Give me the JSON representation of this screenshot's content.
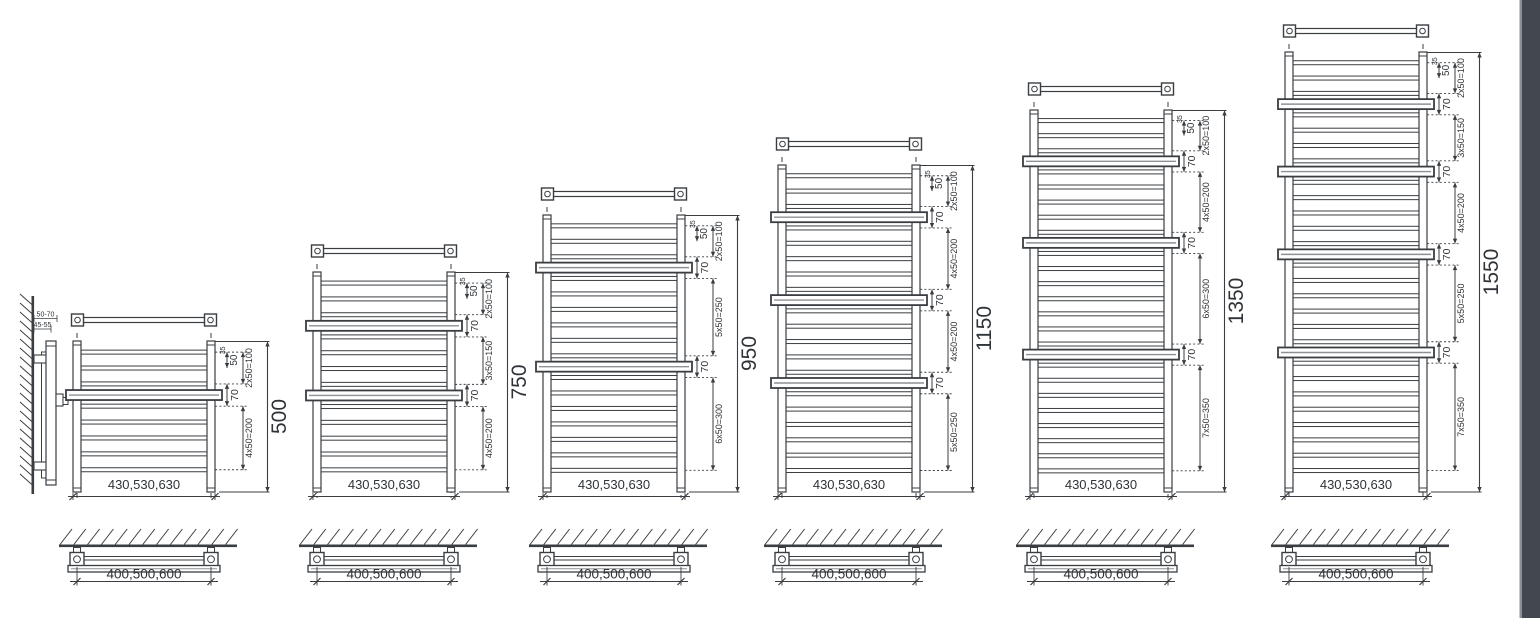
{
  "drawing": {
    "type": "towel-radiator-dimension-diagram",
    "colors": {
      "line": "#3a3e42",
      "text": "#2f3337",
      "mid_gray": "#8d9196",
      "page_edge_strip": "#43484e",
      "page_edge_highlight": "#8a9096"
    }
  },
  "side_view": {
    "wall_distance_label": "50-70",
    "bracket_distance_label": "45-55"
  },
  "footprint": {
    "width_label": "400,500,600"
  },
  "radiators": [
    {
      "height_label": "500",
      "height_mm": 500,
      "width_label": "430,530,630",
      "top_gap_label": "35",
      "first_gap_label": "50",
      "hanger_gap_label": "70",
      "groups": [
        {
          "rungs": 3,
          "label": "2x50=100"
        },
        {
          "rungs": 5,
          "label": "4x50=200"
        }
      ]
    },
    {
      "height_label": "750",
      "height_mm": 750,
      "width_label": "430,530,630",
      "top_gap_label": "35",
      "first_gap_label": "50",
      "hanger_gap_label": "70",
      "groups": [
        {
          "rungs": 3,
          "label": "2x50=100"
        },
        {
          "rungs": 4,
          "label": "3x50=150"
        },
        {
          "rungs": 5,
          "label": "4x50=200"
        }
      ]
    },
    {
      "height_label": "950",
      "height_mm": 950,
      "width_label": "430,530,630",
      "top_gap_label": "35",
      "first_gap_label": "50",
      "hanger_gap_label": "70",
      "groups": [
        {
          "rungs": 3,
          "label": "2x50=100"
        },
        {
          "rungs": 6,
          "label": "5x50=250"
        },
        {
          "rungs": 7,
          "label": "6x50=300"
        }
      ]
    },
    {
      "height_label": "1150",
      "height_mm": 1150,
      "width_label": "430,530,630",
      "top_gap_label": "35",
      "first_gap_label": "50",
      "hanger_gap_label": "70",
      "groups": [
        {
          "rungs": 3,
          "label": "2x50=100"
        },
        {
          "rungs": 5,
          "label": "4x50=200"
        },
        {
          "rungs": 5,
          "label": "4x50=200"
        },
        {
          "rungs": 6,
          "label": "5x50=250"
        }
      ]
    },
    {
      "height_label": "1350",
      "height_mm": 1350,
      "width_label": "430,530,630",
      "top_gap_label": "35",
      "first_gap_label": "50",
      "hanger_gap_label": "70",
      "groups": [
        {
          "rungs": 3,
          "label": "2x50=100"
        },
        {
          "rungs": 5,
          "label": "4x50=200"
        },
        {
          "rungs": 7,
          "label": "6x50=300"
        },
        {
          "rungs": 8,
          "label": "7x50=350"
        }
      ]
    },
    {
      "height_label": "1550",
      "height_mm": 1550,
      "width_label": "430,530,630",
      "top_gap_label": "35",
      "first_gap_label": "50",
      "hanger_gap_label": "70",
      "groups": [
        {
          "rungs": 3,
          "label": "2x50=100"
        },
        {
          "rungs": 4,
          "label": "3x50=150"
        },
        {
          "rungs": 5,
          "label": "4x50=200"
        },
        {
          "rungs": 6,
          "label": "5x50=250"
        },
        {
          "rungs": 8,
          "label": "7x50=350"
        }
      ]
    }
  ]
}
